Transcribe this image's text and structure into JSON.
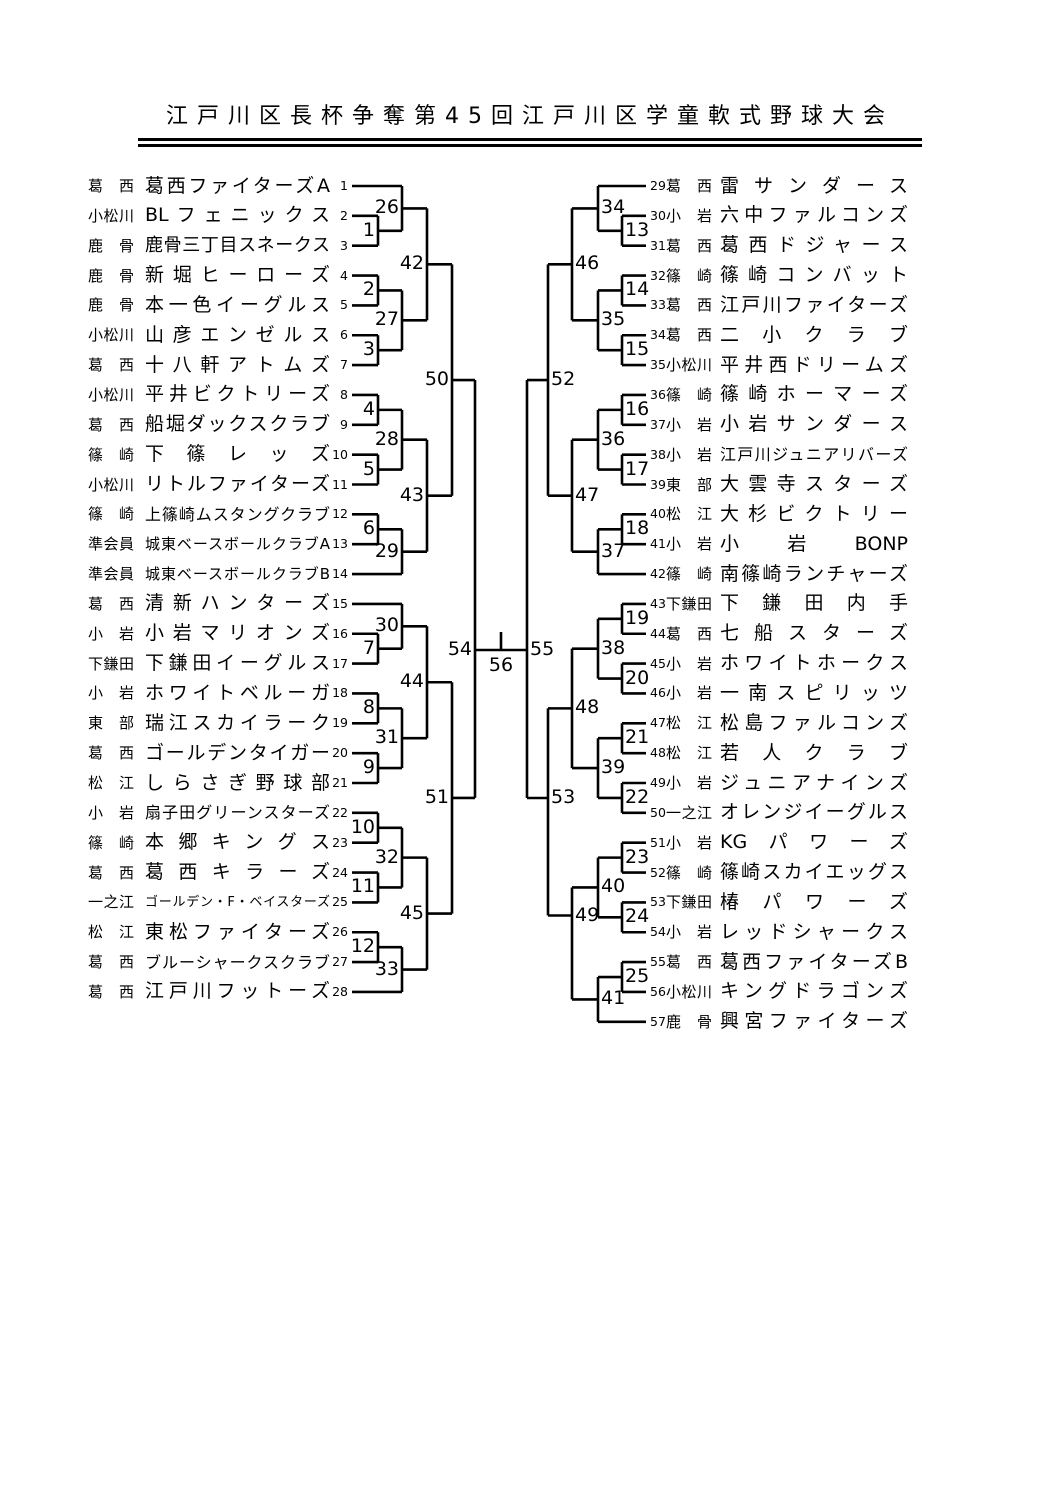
{
  "title": "江戸川区長杯争奪第45回江戸川区学童軟式野球大会",
  "colors": {
    "ink": "#000000",
    "background": "#ffffff"
  },
  "bracket": {
    "teams": [
      {
        "seed": 1,
        "region": "葛西",
        "name": "葛西ファイターズA"
      },
      {
        "seed": 2,
        "region": "小松川",
        "name": "BLフェニックス"
      },
      {
        "seed": 3,
        "region": "鹿骨",
        "name": "鹿骨三丁目スネークス"
      },
      {
        "seed": 4,
        "region": "鹿骨",
        "name": "新堀ヒーローズ"
      },
      {
        "seed": 5,
        "region": "鹿骨",
        "name": "本一色イーグルス"
      },
      {
        "seed": 6,
        "region": "小松川",
        "name": "山彦エンゼルス"
      },
      {
        "seed": 7,
        "region": "葛西",
        "name": "十八軒アトムズ"
      },
      {
        "seed": 8,
        "region": "小松川",
        "name": "平井ビクトリーズ"
      },
      {
        "seed": 9,
        "region": "葛西",
        "name": "船堀ダックスクラブ"
      },
      {
        "seed": 10,
        "region": "篠崎",
        "name": "下篠レッズ"
      },
      {
        "seed": 11,
        "region": "小松川",
        "name": "リトルファイターズ"
      },
      {
        "seed": 12,
        "region": "篠崎",
        "name": "上篠崎ムスタングクラブ"
      },
      {
        "seed": 13,
        "region": "準会員",
        "name": "城東ベースボールクラブA"
      },
      {
        "seed": 14,
        "region": "準会員",
        "name": "城東ベースボールクラブB"
      },
      {
        "seed": 15,
        "region": "葛西",
        "name": "清新ハンターズ"
      },
      {
        "seed": 16,
        "region": "小岩",
        "name": "小岩マリオンズ"
      },
      {
        "seed": 17,
        "region": "下鎌田",
        "name": "下鎌田イーグルス"
      },
      {
        "seed": 18,
        "region": "小岩",
        "name": "ホワイトベルーガ"
      },
      {
        "seed": 19,
        "region": "東部",
        "name": "瑞江スカイラーク"
      },
      {
        "seed": 20,
        "region": "葛西",
        "name": "ゴールデンタイガー"
      },
      {
        "seed": 21,
        "region": "松江",
        "name": "しらさぎ野球部"
      },
      {
        "seed": 22,
        "region": "小岩",
        "name": "扇子田グリーンスターズ"
      },
      {
        "seed": 23,
        "region": "篠崎",
        "name": "本郷キングス"
      },
      {
        "seed": 24,
        "region": "葛西",
        "name": "葛西キラーズ"
      },
      {
        "seed": 25,
        "region": "一之江",
        "name": "ゴールデン・F・ベイスターズ"
      },
      {
        "seed": 26,
        "region": "松江",
        "name": "東松ファイターズ"
      },
      {
        "seed": 27,
        "region": "葛西",
        "name": "ブルーシャークスクラブ"
      },
      {
        "seed": 28,
        "region": "葛西",
        "name": "江戸川フットーズ"
      },
      {
        "seed": 29,
        "region": "葛西",
        "name": "雷サンダース"
      },
      {
        "seed": 30,
        "region": "小岩",
        "name": "六中ファルコンズ"
      },
      {
        "seed": 31,
        "region": "葛西",
        "name": "葛西ドジャース"
      },
      {
        "seed": 32,
        "region": "篠崎",
        "name": "篠崎コンバット"
      },
      {
        "seed": 33,
        "region": "葛西",
        "name": "江戸川ファイターズ"
      },
      {
        "seed": 34,
        "region": "葛西",
        "name": "二小クラブ"
      },
      {
        "seed": 35,
        "region": "小松川",
        "name": "平井西ドリームズ"
      },
      {
        "seed": 36,
        "region": "篠崎",
        "name": "篠崎ホーマーズ"
      },
      {
        "seed": 37,
        "region": "小岩",
        "name": "小岩サンダース"
      },
      {
        "seed": 38,
        "region": "小岩",
        "name": "江戸川ジュニアリバーズ"
      },
      {
        "seed": 39,
        "region": "東部",
        "name": "大雲寺スターズ"
      },
      {
        "seed": 40,
        "region": "松江",
        "name": "大杉ビクトリー"
      },
      {
        "seed": 41,
        "region": "小岩",
        "name": "小岩BONP"
      },
      {
        "seed": 42,
        "region": "篠崎",
        "name": "南篠崎ランチャーズ"
      },
      {
        "seed": 43,
        "region": "下鎌田",
        "name": "下鎌田内手"
      },
      {
        "seed": 44,
        "region": "葛西",
        "name": "七船スターズ"
      },
      {
        "seed": 45,
        "region": "小岩",
        "name": "ホワイトホークス"
      },
      {
        "seed": 46,
        "region": "小岩",
        "name": "一南スピリッツ"
      },
      {
        "seed": 47,
        "region": "松江",
        "name": "松島ファルコンズ"
      },
      {
        "seed": 48,
        "region": "松江",
        "name": "若人クラブ"
      },
      {
        "seed": 49,
        "region": "小岩",
        "name": "ジュニアナインズ"
      },
      {
        "seed": 50,
        "region": "一之江",
        "name": "オレンジイーグルス"
      },
      {
        "seed": 51,
        "region": "小岩",
        "name": "KGパワーズ"
      },
      {
        "seed": 52,
        "region": "篠崎",
        "name": "篠崎スカイエッグス"
      },
      {
        "seed": 53,
        "region": "下鎌田",
        "name": "椿パワーズ"
      },
      {
        "seed": 54,
        "region": "小岩",
        "name": "レッドシャークス"
      },
      {
        "seed": 55,
        "region": "葛西",
        "name": "葛西ファイターズB"
      },
      {
        "seed": 56,
        "region": "小松川",
        "name": "キングドラゴンズ"
      },
      {
        "seed": 57,
        "region": "鹿骨",
        "name": "興宮ファイターズ"
      }
    ],
    "matches": [
      {
        "n": 1,
        "side": "L",
        "round": 1,
        "a": "T2",
        "b": "T3"
      },
      {
        "n": 2,
        "side": "L",
        "round": 1,
        "a": "T4",
        "b": "T5"
      },
      {
        "n": 3,
        "side": "L",
        "round": 1,
        "a": "T6",
        "b": "T7"
      },
      {
        "n": 4,
        "side": "L",
        "round": 1,
        "a": "T8",
        "b": "T9"
      },
      {
        "n": 5,
        "side": "L",
        "round": 1,
        "a": "T10",
        "b": "T11"
      },
      {
        "n": 6,
        "side": "L",
        "round": 1,
        "a": "T12",
        "b": "T13"
      },
      {
        "n": 7,
        "side": "L",
        "round": 1,
        "a": "T16",
        "b": "T17"
      },
      {
        "n": 8,
        "side": "L",
        "round": 1,
        "a": "T18",
        "b": "T19"
      },
      {
        "n": 9,
        "side": "L",
        "round": 1,
        "a": "T20",
        "b": "T21"
      },
      {
        "n": 10,
        "side": "L",
        "round": 1,
        "a": "T22",
        "b": "T23"
      },
      {
        "n": 11,
        "side": "L",
        "round": 1,
        "a": "T24",
        "b": "T25"
      },
      {
        "n": 12,
        "side": "L",
        "round": 1,
        "a": "T26",
        "b": "T27"
      },
      {
        "n": 13,
        "side": "R",
        "round": 1,
        "a": "T30",
        "b": "T31"
      },
      {
        "n": 14,
        "side": "R",
        "round": 1,
        "a": "T32",
        "b": "T33"
      },
      {
        "n": 15,
        "side": "R",
        "round": 1,
        "a": "T34",
        "b": "T35"
      },
      {
        "n": 16,
        "side": "R",
        "round": 1,
        "a": "T36",
        "b": "T37"
      },
      {
        "n": 17,
        "side": "R",
        "round": 1,
        "a": "T38",
        "b": "T39"
      },
      {
        "n": 18,
        "side": "R",
        "round": 1,
        "a": "T40",
        "b": "T41"
      },
      {
        "n": 19,
        "side": "R",
        "round": 1,
        "a": "T43",
        "b": "T44"
      },
      {
        "n": 20,
        "side": "R",
        "round": 1,
        "a": "T45",
        "b": "T46"
      },
      {
        "n": 21,
        "side": "R",
        "round": 1,
        "a": "T47",
        "b": "T48"
      },
      {
        "n": 22,
        "side": "R",
        "round": 1,
        "a": "T49",
        "b": "T50"
      },
      {
        "n": 23,
        "side": "R",
        "round": 1,
        "a": "T51",
        "b": "T52"
      },
      {
        "n": 24,
        "side": "R",
        "round": 1,
        "a": "T53",
        "b": "T54"
      },
      {
        "n": 25,
        "side": "R",
        "round": 1,
        "a": "T55",
        "b": "T56"
      },
      {
        "n": 26,
        "side": "L",
        "round": 2,
        "a": "T1",
        "b": "M1"
      },
      {
        "n": 27,
        "side": "L",
        "round": 2,
        "a": "M2",
        "b": "M3"
      },
      {
        "n": 28,
        "side": "L",
        "round": 2,
        "a": "M4",
        "b": "M5"
      },
      {
        "n": 29,
        "side": "L",
        "round": 2,
        "a": "M6",
        "b": "T14"
      },
      {
        "n": 30,
        "side": "L",
        "round": 2,
        "a": "T15",
        "b": "M7"
      },
      {
        "n": 31,
        "side": "L",
        "round": 2,
        "a": "M8",
        "b": "M9"
      },
      {
        "n": 32,
        "side": "L",
        "round": 2,
        "a": "M10",
        "b": "M11"
      },
      {
        "n": 33,
        "side": "L",
        "round": 2,
        "a": "M12",
        "b": "T28"
      },
      {
        "n": 34,
        "side": "R",
        "round": 2,
        "a": "T29",
        "b": "M13"
      },
      {
        "n": 35,
        "side": "R",
        "round": 2,
        "a": "M14",
        "b": "M15"
      },
      {
        "n": 36,
        "side": "R",
        "round": 2,
        "a": "M16",
        "b": "M17"
      },
      {
        "n": 37,
        "side": "R",
        "round": 2,
        "a": "M18",
        "b": "T42"
      },
      {
        "n": 38,
        "side": "R",
        "round": 2,
        "a": "M19",
        "b": "M20"
      },
      {
        "n": 39,
        "side": "R",
        "round": 2,
        "a": "M21",
        "b": "M22"
      },
      {
        "n": 40,
        "side": "R",
        "round": 2,
        "a": "M23",
        "b": "M24"
      },
      {
        "n": 41,
        "side": "R",
        "round": 2,
        "a": "M25",
        "b": "T57"
      },
      {
        "n": 42,
        "side": "L",
        "round": 3,
        "a": "M26",
        "b": "M27"
      },
      {
        "n": 43,
        "side": "L",
        "round": 3,
        "a": "M28",
        "b": "M29"
      },
      {
        "n": 44,
        "side": "L",
        "round": 3,
        "a": "M30",
        "b": "M31"
      },
      {
        "n": 45,
        "side": "L",
        "round": 3,
        "a": "M32",
        "b": "M33"
      },
      {
        "n": 46,
        "side": "R",
        "round": 3,
        "a": "M34",
        "b": "M35"
      },
      {
        "n": 47,
        "side": "R",
        "round": 3,
        "a": "M36",
        "b": "M37"
      },
      {
        "n": 48,
        "side": "R",
        "round": 3,
        "a": "M38",
        "b": "M39"
      },
      {
        "n": 49,
        "side": "R",
        "round": 3,
        "a": "M40",
        "b": "M41"
      },
      {
        "n": 50,
        "side": "L",
        "round": 4,
        "a": "M42",
        "b": "M43"
      },
      {
        "n": 51,
        "side": "L",
        "round": 4,
        "a": "M44",
        "b": "M45"
      },
      {
        "n": 52,
        "side": "R",
        "round": 4,
        "a": "M46",
        "b": "M47"
      },
      {
        "n": 53,
        "side": "R",
        "round": 4,
        "a": "M48",
        "b": "M49"
      },
      {
        "n": 54,
        "side": "L",
        "round": 5,
        "a": "M50",
        "b": "M51"
      },
      {
        "n": 55,
        "side": "R",
        "round": 5,
        "a": "M52",
        "b": "M53"
      },
      {
        "n": 56,
        "side": "F",
        "round": 6,
        "a": "M54",
        "b": "M55"
      }
    ]
  }
}
